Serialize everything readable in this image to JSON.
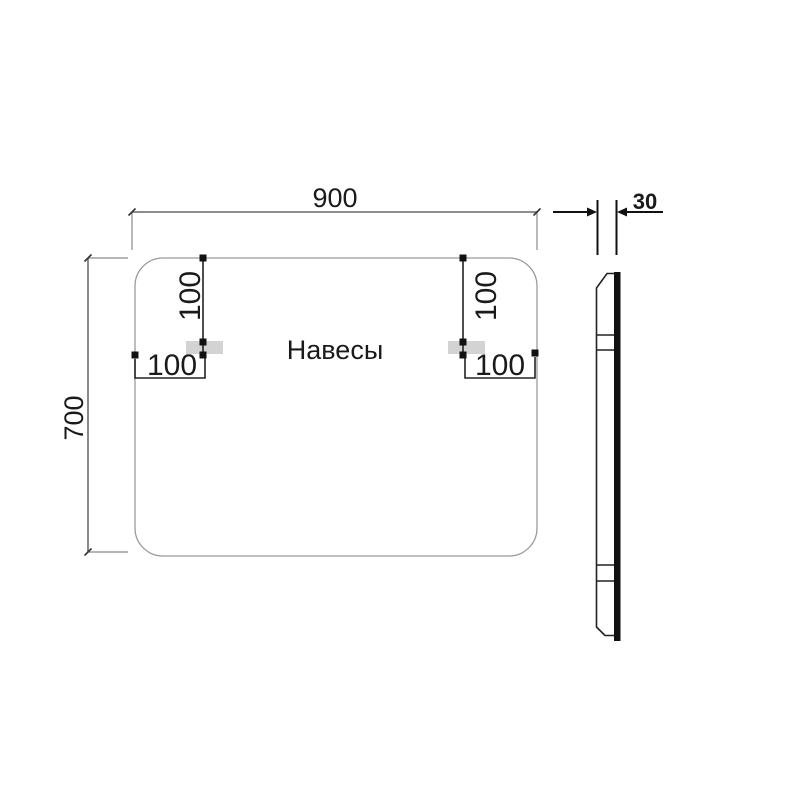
{
  "drawing": {
    "caption": "Навесы",
    "dimensions": {
      "width": {
        "value": "900"
      },
      "height": {
        "value": "700"
      },
      "thickness": {
        "value": "30"
      },
      "hanger_top_offset_left": {
        "value": "100"
      },
      "hanger_top_offset_right": {
        "value": "100"
      },
      "hanger_side_offset_left": {
        "value": "100"
      },
      "hanger_side_offset_right": {
        "value": "100"
      }
    },
    "colors": {
      "background": "#ffffff",
      "mirror_outline": "#9a9a9a",
      "dimension_line": "#7d7d7d",
      "dark_line": "#1c1c1c",
      "text": "#1a1a1a",
      "hanger_fill": "#d3d3d3"
    }
  }
}
